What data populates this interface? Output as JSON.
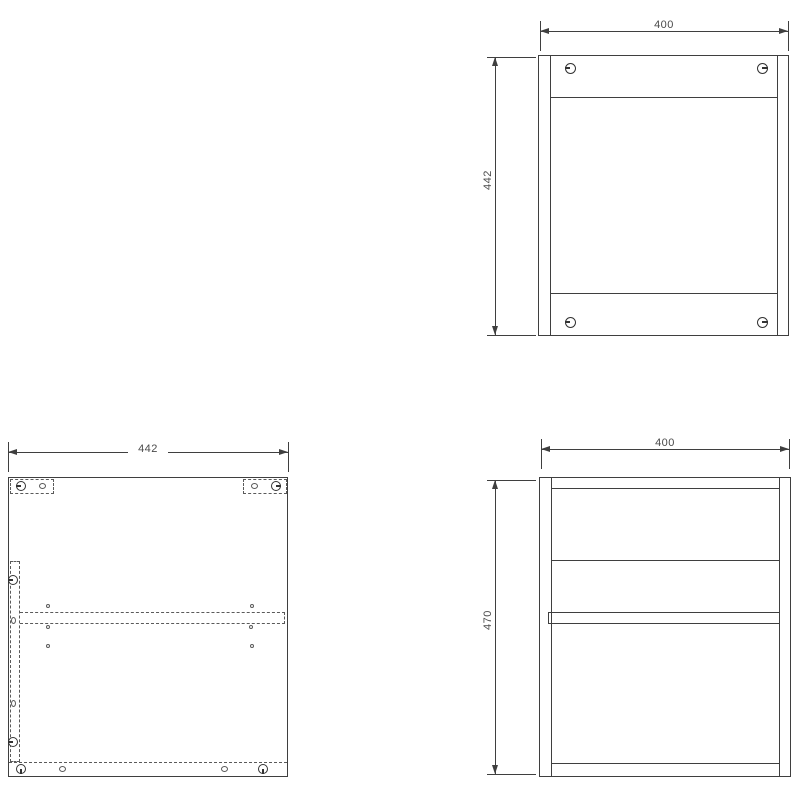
{
  "palette": {
    "background": "#ffffff",
    "line_color": "#3f3f3f",
    "dashed_color": "#5a5a5a",
    "text_color": "#4a4a4a"
  },
  "drawing": {
    "type": "cabinet-assembly-orthographic-views",
    "views": [
      {
        "id": "front-view",
        "position": "top-right",
        "width_mm": 400,
        "height_mm": 442
      },
      {
        "id": "side-panel-drilling-view",
        "position": "bottom-left",
        "width_mm": 442
      },
      {
        "id": "side-view",
        "position": "bottom-right",
        "width_mm": 400,
        "height_mm": 470
      }
    ]
  },
  "dimensions": {
    "front_width": "400",
    "front_height": "442",
    "panel_width": "442",
    "side_width": "400",
    "side_height": "470"
  },
  "markers": [
    {
      "icon": "cam-lock-icon",
      "type": "cam",
      "x": 570,
      "y": 68,
      "w": 11,
      "h": 11,
      "dir": "left"
    },
    {
      "icon": "cam-lock-icon",
      "type": "cam",
      "x": 762,
      "y": 68,
      "w": 11,
      "h": 11,
      "dir": "right"
    },
    {
      "icon": "cam-lock-icon",
      "type": "cam",
      "x": 570,
      "y": 322,
      "w": 11,
      "h": 11,
      "dir": "left"
    },
    {
      "icon": "cam-lock-icon",
      "type": "cam",
      "x": 762,
      "y": 322,
      "w": 11,
      "h": 11,
      "dir": "right"
    },
    {
      "icon": "cam-lock-icon",
      "type": "cam",
      "x": 21,
      "y": 486,
      "w": 10,
      "h": 10,
      "dir": "left"
    },
    {
      "icon": "cam-lock-icon",
      "type": "cam",
      "x": 276,
      "y": 486,
      "w": 10,
      "h": 10,
      "dir": "right"
    },
    {
      "icon": "cam-lock-icon",
      "type": "cam",
      "x": 13,
      "y": 580,
      "w": 10,
      "h": 10,
      "dir": "left"
    },
    {
      "icon": "cam-lock-icon",
      "type": "cam",
      "x": 13,
      "y": 742,
      "w": 10,
      "h": 10,
      "dir": "left"
    },
    {
      "icon": "cam-lock-icon",
      "type": "cam",
      "x": 21,
      "y": 769,
      "w": 10,
      "h": 10,
      "dir": "down"
    },
    {
      "icon": "cam-lock-icon",
      "type": "cam",
      "x": 263,
      "y": 769,
      "w": 10,
      "h": 10,
      "dir": "down"
    },
    {
      "icon": "dowel-hole-icon",
      "type": "dowel",
      "x": 42,
      "y": 486,
      "w": 7,
      "h": 6
    },
    {
      "icon": "dowel-hole-icon",
      "type": "dowel",
      "x": 254,
      "y": 486,
      "w": 7,
      "h": 6
    },
    {
      "icon": "dowel-hole-icon",
      "type": "dowel",
      "x": 13,
      "y": 620,
      "w": 5,
      "h": 7
    },
    {
      "icon": "dowel-hole-icon",
      "type": "dowel",
      "x": 13,
      "y": 703,
      "w": 5,
      "h": 7
    },
    {
      "icon": "dowel-hole-icon",
      "type": "dowel",
      "x": 62,
      "y": 769,
      "w": 7,
      "h": 6
    },
    {
      "icon": "dowel-hole-icon",
      "type": "dowel",
      "x": 224,
      "y": 769,
      "w": 7,
      "h": 6
    },
    {
      "icon": "shelf-pin-hole-icon",
      "type": "hole",
      "x": 48,
      "y": 606,
      "w": 4,
      "h": 4
    },
    {
      "icon": "shelf-pin-hole-icon",
      "type": "hole",
      "x": 252,
      "y": 606,
      "w": 4,
      "h": 4
    },
    {
      "icon": "shelf-pin-hole-icon",
      "type": "hole",
      "x": 48,
      "y": 627,
      "w": 4,
      "h": 4
    },
    {
      "icon": "shelf-pin-hole-icon",
      "type": "hole",
      "x": 251,
      "y": 627,
      "w": 4,
      "h": 4
    },
    {
      "icon": "shelf-pin-hole-icon",
      "type": "hole",
      "x": 48,
      "y": 646,
      "w": 4,
      "h": 4
    },
    {
      "icon": "shelf-pin-hole-icon",
      "type": "hole",
      "x": 252,
      "y": 646,
      "w": 4,
      "h": 4
    }
  ]
}
